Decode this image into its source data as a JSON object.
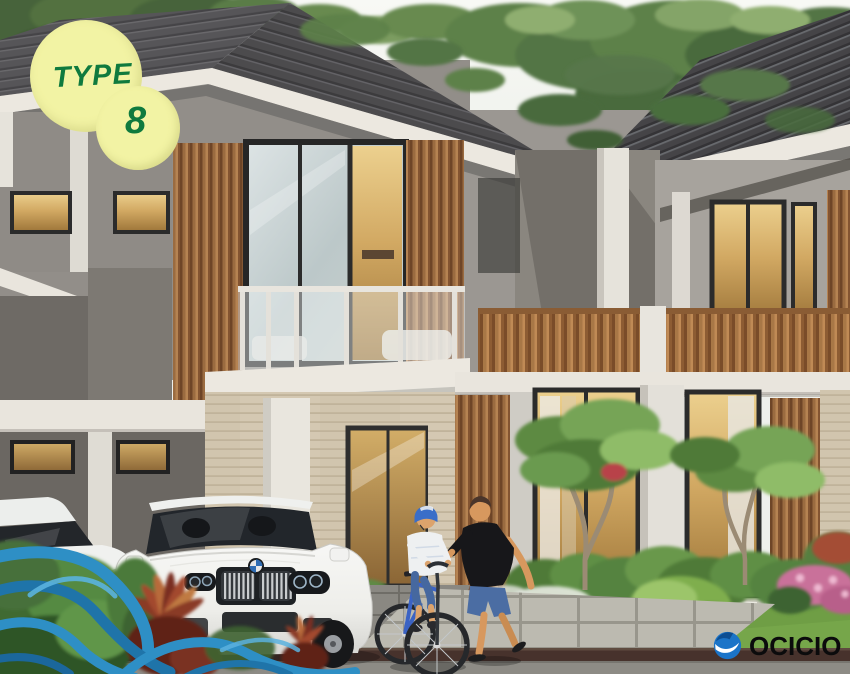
{
  "badge": {
    "label": "TYPE",
    "number": "8"
  },
  "watermark": {
    "brand": "OCICIO"
  },
  "scene": {
    "description": "3D architectural rendering of modern two-storey tropical townhouses (unit Type 8) with timber-slat accents, glass balcony, carport with a white SUV and a white sedan, a man jogging beside a boy riding a blue bicycle, frangipani garden, and decorative blue wave graphics in the lower-left corner."
  },
  "icons": {
    "logo_mark": "ocicio-wave-circle-icon",
    "badge_shape": "double-circle-badge"
  },
  "colors": {
    "badge_background": "#f2f3a4",
    "badge_text_green": "#0f7a3e",
    "wave_blue": "#2e8fc5",
    "logo_blue": "#1b74c8",
    "logo_text_black": "#0b0b0c",
    "roof_gray": "#4b4a4c",
    "timber_brown": "#9a6b40",
    "wall_gray": "#938f8a",
    "stone_beige": "#d0c4ad",
    "foliage_green": "#5d8148"
  }
}
